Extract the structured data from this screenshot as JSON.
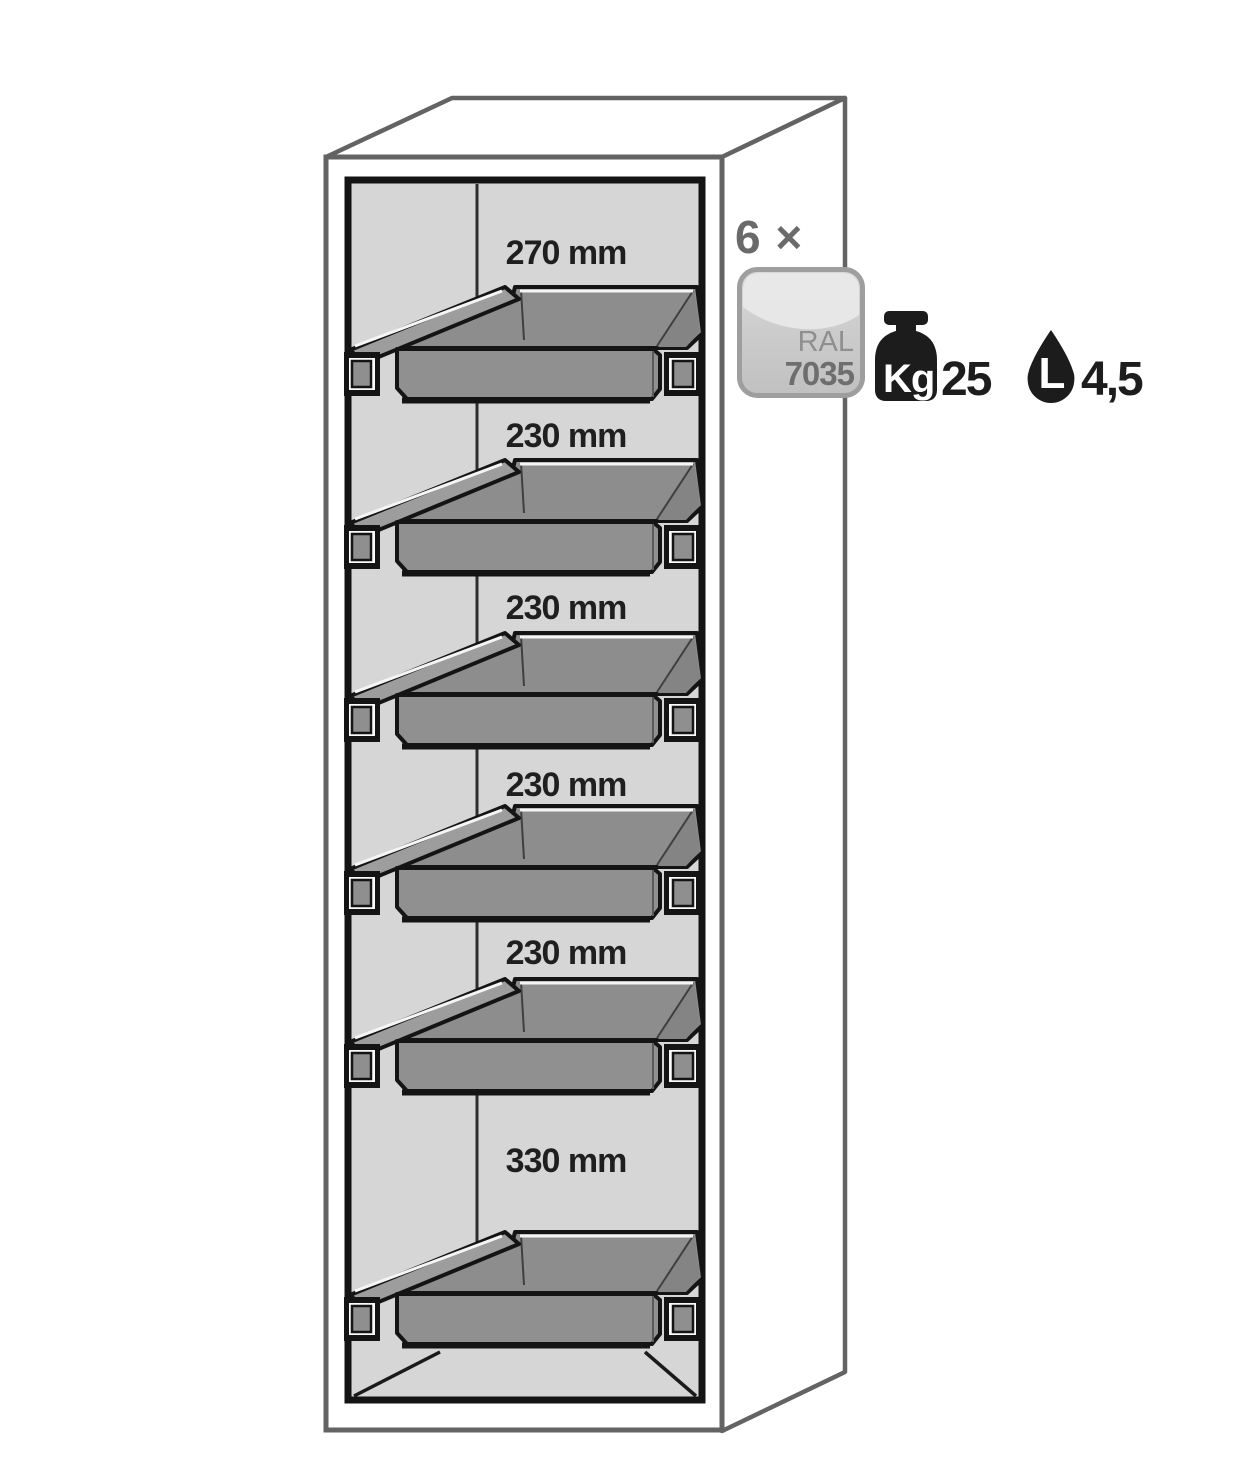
{
  "cabinet": {
    "description": "safety cabinet with pull-out trays",
    "compartments": [
      {
        "label": "270 mm"
      },
      {
        "label": "230 mm"
      },
      {
        "label": "230 mm"
      },
      {
        "label": "230 mm"
      },
      {
        "label": "230 mm"
      },
      {
        "label": "330 mm"
      }
    ]
  },
  "annotation": {
    "count_label": "6 ×",
    "ral_badge": {
      "line1": "RAL",
      "line2": "7035"
    },
    "weight": {
      "unit": "Kg",
      "value": "25"
    },
    "volume": {
      "unit": "L",
      "value": "4,5"
    }
  },
  "colors": {
    "interior_gray": "#d6d6d6",
    "tray_gray": "#909090",
    "shelf_gray": "#9d9d9d",
    "outline_black": "#141414",
    "cabinet_edge_gray": "#636363",
    "label_text": "#1f1f1f",
    "badge_border": "#9e9e9e",
    "badge_fill": "#cccccc",
    "icon_black": "#1c1c1c"
  }
}
